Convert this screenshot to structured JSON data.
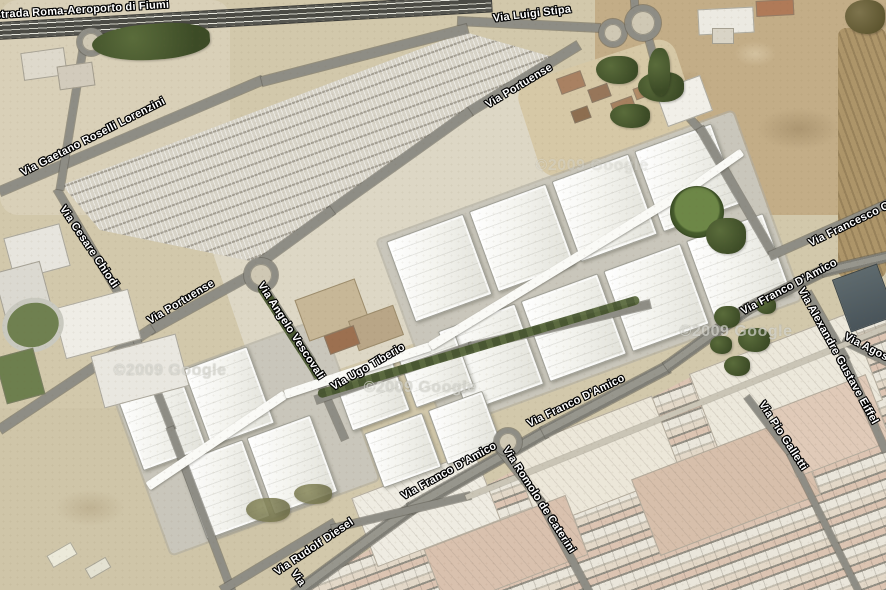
{
  "map": {
    "labels": [
      {
        "text": "strada Roma-Aeroporto di Fiumi"
      },
      {
        "text": "Via Luigi Stipa"
      },
      {
        "text": "Via Portuense"
      },
      {
        "text": "Via Gaetano Roselli Lorenzini"
      },
      {
        "text": "Via Cesare Chiodi"
      },
      {
        "text": "Via Portuense"
      },
      {
        "text": "Via Angelo Vescovali"
      },
      {
        "text": "Via Ugo Tiberio"
      },
      {
        "text": "Via Francesco Cil"
      },
      {
        "text": "Via Franco D'Amico"
      },
      {
        "text": "Via Alexandre Gustave Eiffel"
      },
      {
        "text": "Via Agost"
      },
      {
        "text": "Via Franco D'Amico"
      },
      {
        "text": "Via Franco D'Amico"
      },
      {
        "text": "Via Romolo de Caterini"
      },
      {
        "text": "Via Pio Galletti"
      },
      {
        "text": "Via Rudolf Diesel"
      },
      {
        "text": "Via"
      }
    ],
    "watermark": {
      "text": "©2009 Google"
    },
    "palette": {
      "label_text": "#ffffff",
      "label_halo": "#000000",
      "asphalt": "#8e8d85",
      "highway": "#4a4a44",
      "terrain_sand": "#d2c8ab",
      "terrain_dirt": "#c3ad87",
      "roof_white": "#f4f4ef",
      "roof_salmon": "#dcc4b2",
      "vegetation": "#48552f"
    }
  }
}
